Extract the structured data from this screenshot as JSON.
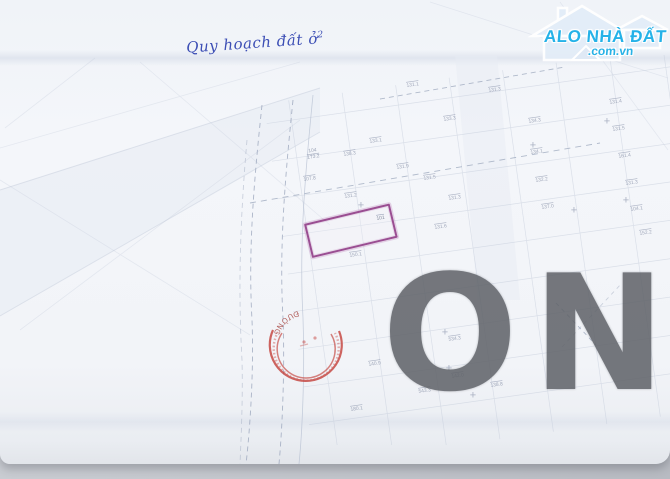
{
  "note": {
    "text": "Quy hoạch đất ở",
    "sup": "2"
  },
  "logo": {
    "title": "ALO NHÀ ĐẤT",
    "domain": ".com.vn",
    "color": "#25b2e8"
  },
  "watermark": {
    "text": "ON",
    "color": "#5e6167"
  },
  "stamp": {
    "rim_text": "ĐƯỜNG",
    "color": "#c4403a"
  },
  "highlight": {
    "outline_color": "#9a4e92",
    "plot_label": "101"
  },
  "map": {
    "cross": "+",
    "fraction": {
      "top": "104",
      "bottom": "173.2"
    },
    "labels": [
      {
        "text": "138.3"
      },
      {
        "text": "107.8"
      },
      {
        "text": "131.2"
      },
      {
        "text": "150.1"
      },
      {
        "text": "133.3"
      },
      {
        "text": "131.3"
      },
      {
        "text": "134.3"
      },
      {
        "text": "131.4"
      },
      {
        "text": "131.5"
      },
      {
        "text": "161.4"
      },
      {
        "text": "131.3"
      },
      {
        "text": "104.1"
      },
      {
        "text": "152.2"
      },
      {
        "text": "134.1"
      },
      {
        "text": "132.2"
      },
      {
        "text": "137.0"
      },
      {
        "text": "131.5"
      },
      {
        "text": "131.3"
      },
      {
        "text": "131.6"
      },
      {
        "text": "534.3"
      },
      {
        "text": "142.0"
      },
      {
        "text": "543.3"
      },
      {
        "text": "140.9"
      },
      {
        "text": "180.1"
      },
      {
        "text": "138.8"
      },
      {
        "text": "131.1"
      },
      {
        "text": "133.1"
      },
      {
        "text": "131.9"
      }
    ]
  }
}
